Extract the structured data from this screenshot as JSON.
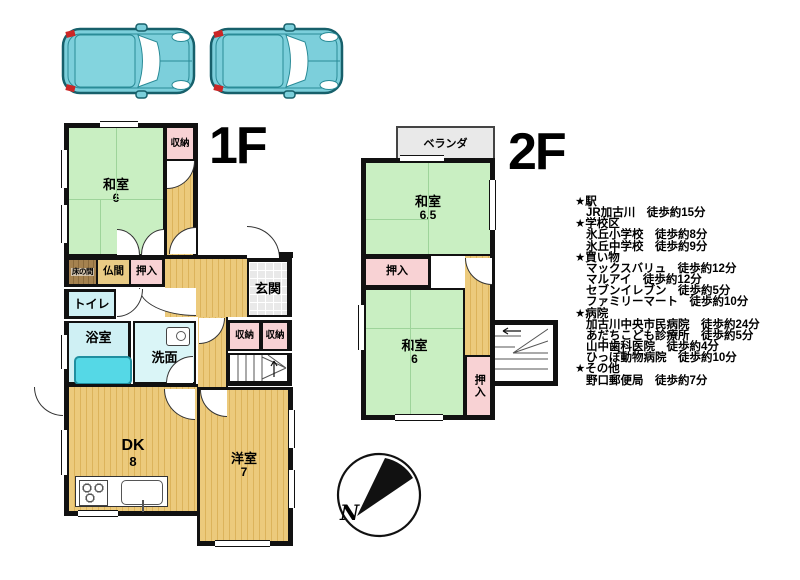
{
  "floor1": {
    "label": "1F",
    "rooms": {
      "washitsu": {
        "name": "和室",
        "size": "6"
      },
      "shuno_top": {
        "name": "収納"
      },
      "tokonoma": {
        "name": "床の間"
      },
      "butsuma": {
        "name": "仏間"
      },
      "oshiire": {
        "name": "押入"
      },
      "toilet": {
        "name": "トイレ"
      },
      "bath": {
        "name": "浴室"
      },
      "senmen": {
        "name": "洗面"
      },
      "genkan": {
        "name": "玄関"
      },
      "shuno_a": {
        "name": "収納"
      },
      "shuno_b": {
        "name": "収納"
      },
      "katteguchi": {
        "name": "勝手口"
      },
      "dk": {
        "name": "DK",
        "size": "8"
      },
      "yoshitsu": {
        "name": "洋室",
        "size": "7"
      }
    }
  },
  "floor2": {
    "label": "2F",
    "veranda": "ベランダ",
    "rooms": {
      "washitsu65": {
        "name": "和室",
        "size": "6.5"
      },
      "oshiire_a": {
        "name": "押入"
      },
      "washitsu6": {
        "name": "和室",
        "size": "6"
      },
      "oshiire_b": {
        "name": "押入"
      }
    }
  },
  "compass": {
    "north": "N"
  },
  "info": {
    "sections": [
      {
        "heading": "★駅",
        "items": [
          "JR加古川　徒歩約15分"
        ]
      },
      {
        "heading": "★学校区",
        "items": [
          "氷丘小学校　徒歩約8分",
          "氷丘中学校　徒歩約9分"
        ]
      },
      {
        "heading": "★買い物",
        "items": [
          "マックスバリュ　徒歩約12分",
          "マルアイ　徒歩約12分",
          "セブンイレブン　徒歩約5分",
          "ファミリーマート　徒歩約10分"
        ]
      },
      {
        "heading": "★病院",
        "items": [
          "加古川中央市民病院　徒歩約24分",
          "あだちこども診療所　徒歩約5分",
          "山中歯科医院　徒歩約4分",
          "ひっぽ動物病院　徒歩約10分"
        ]
      },
      {
        "heading": "★その他",
        "items": [
          "野口郵便局　徒歩約7分"
        ]
      }
    ]
  },
  "colors": {
    "tatami_green": "#c9efc2",
    "floor_tan": "#ecca7c",
    "closet_pink": "#f8d2d4",
    "wet_cyan": "#cff0f4",
    "bathtub_cyan": "#55d8e6",
    "entrance_gray": "#e9e9e9",
    "tokonoma_brown": "#a5824f",
    "wall_black": "#111111",
    "car_teal": "#7ccfdb"
  }
}
